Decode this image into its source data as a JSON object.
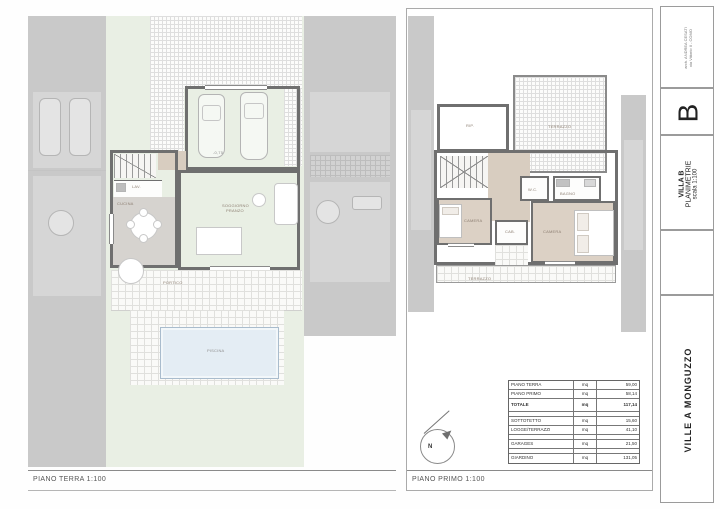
{
  "page": {
    "left_plan_caption": "PIANO TERRA  1:100",
    "right_plan_caption": "PIANO PRIMO  1:100"
  },
  "title_block": {
    "architect_line1": "arch. ANDREA CESATI",
    "architect_line2": "via Vittorio II - COMO",
    "villa_letter": "B",
    "villa_name": "VILLA B",
    "drawing_type": "PLANIMETRIE",
    "scale": "scala 1:100",
    "project": "VILLE A MONGUZZO"
  },
  "compass": {
    "north": "N"
  },
  "ground_floor": {
    "garage_level": "-0,75",
    "labels": {
      "cucina": "CUCINA",
      "lavanderia": "LAV.",
      "soggiorno": "SOGGIORNO",
      "pranzo": "PRANZO",
      "portico": "PORTICO",
      "piscina": "PISCINA"
    }
  },
  "first_floor": {
    "labels": {
      "terrazzo": "TERRAZZO",
      "ripostiglio": "RIP.",
      "camera1": "CAMERA",
      "camera2": "CAMERA",
      "bagno": "BAGNO",
      "wc": "W.C.",
      "cabina": "CAB.",
      "terrazzo2": "TERRAZZO"
    }
  },
  "area_table": {
    "rows": [
      {
        "label": "PIANO TERRA",
        "unit": "mq",
        "value": "59,00"
      },
      {
        "label": "PIANO PRIMO",
        "unit": "mq",
        "value": "58,14"
      },
      {
        "label": "TOTALE",
        "unit": "mq",
        "value": "117,14"
      },
      {
        "label": "",
        "unit": "",
        "value": ""
      },
      {
        "label": "SOTTOTETTO",
        "unit": "mq",
        "value": "15,60"
      },
      {
        "label": "LOGGE/TERRAZZI",
        "unit": "mq",
        "value": "41,10"
      },
      {
        "label": "",
        "unit": "",
        "value": ""
      },
      {
        "label": "GARAGES",
        "unit": "mq",
        "value": "21,50"
      },
      {
        "label": "",
        "unit": "",
        "value": ""
      },
      {
        "label": "GIARDINO",
        "unit": "mq",
        "value": "131,05"
      }
    ]
  }
}
